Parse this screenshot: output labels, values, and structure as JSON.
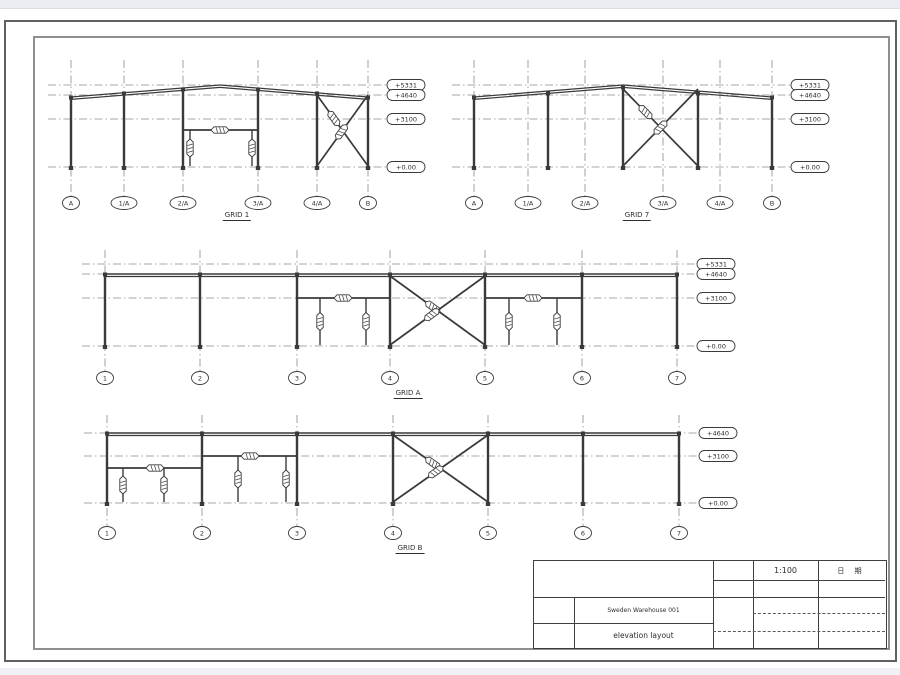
{
  "colors": {
    "member_line": "#3a3a3a",
    "grid_line": "#8a8a8a",
    "border_outer": "#606060",
    "border_inner": "#8f8f8f",
    "chrome_strip": "#ecedf2",
    "paper": "#ffffff"
  },
  "title_block": {
    "scale": "1:100",
    "date_label": "日 期",
    "project": "Sweden Warehouse 001",
    "sheet_title": "elevation layout"
  },
  "views": [
    {
      "name": "GRID 1",
      "caption": {
        "x": 237,
        "y": 211
      },
      "grids": [
        {
          "label": "A",
          "x": 71
        },
        {
          "label": "1/A",
          "x": 124
        },
        {
          "label": "2/A",
          "x": 183
        },
        {
          "label": "3/A",
          "x": 258
        },
        {
          "label": "4/A",
          "x": 317
        },
        {
          "label": "B",
          "x": 368
        }
      ],
      "bubble_y": 203,
      "grid_top": 60,
      "grid_bottom": 195,
      "levels": [
        {
          "label": "+5331",
          "y": 85
        },
        {
          "label": "+4640",
          "y": 95
        },
        {
          "label": "+3100",
          "y": 119
        },
        {
          "label": "+0.00",
          "y": 167
        }
      ],
      "level_x1": 48,
      "tag_x": 406,
      "rafters": [
        [
          71,
          97,
          220,
          85
        ],
        [
          220,
          85,
          368,
          97
        ]
      ],
      "beams": [],
      "columns": [
        [
          71,
          97,
          167
        ],
        [
          124,
          93,
          167
        ],
        [
          183,
          89,
          167
        ],
        [
          258,
          89,
          167
        ],
        [
          317,
          93,
          167
        ],
        [
          368,
          97,
          167
        ]
      ],
      "braces": [
        {
          "x1": 317,
          "y1": 95,
          "x2": 368,
          "y2": 166,
          "t": 0.33
        },
        {
          "x1": 368,
          "y1": 95,
          "x2": 317,
          "y2": 166,
          "t": 0.52
        }
      ],
      "struts": [
        {
          "x1": 183,
          "x2": 258,
          "y": 130,
          "tb": 220
        }
      ],
      "hangers": [
        [
          190,
          130,
          166
        ],
        [
          252,
          130,
          166
        ]
      ]
    },
    {
      "name": "GRID 7",
      "caption": {
        "x": 637,
        "y": 211
      },
      "grids": [
        {
          "label": "A",
          "x": 474
        },
        {
          "label": "1/A",
          "x": 528
        },
        {
          "label": "2/A",
          "x": 585
        },
        {
          "label": "3/A",
          "x": 663
        },
        {
          "label": "4/A",
          "x": 720
        },
        {
          "label": "B",
          "x": 772
        }
      ],
      "bubble_y": 203,
      "grid_top": 60,
      "grid_bottom": 195,
      "levels": [
        {
          "label": "+5331",
          "y": 85
        },
        {
          "label": "+4640",
          "y": 95
        },
        {
          "label": "+3100",
          "y": 119
        },
        {
          "label": "+0.00",
          "y": 167
        }
      ],
      "level_x1": 452,
      "tag_x": 810,
      "rafters": [
        [
          474,
          97,
          623,
          85
        ],
        [
          623,
          85,
          772,
          97
        ]
      ],
      "beams": [],
      "columns": [
        [
          474,
          97,
          167
        ],
        [
          548,
          93,
          167
        ],
        [
          623,
          87,
          167
        ],
        [
          698,
          93,
          167
        ],
        [
          772,
          97,
          167
        ]
      ],
      "braces": [
        {
          "x1": 623,
          "y1": 89,
          "x2": 698,
          "y2": 166,
          "t": 0.3
        },
        {
          "x1": 698,
          "y1": 89,
          "x2": 623,
          "y2": 166,
          "t": 0.5
        }
      ],
      "struts": [],
      "hangers": []
    },
    {
      "name": "GRID A",
      "caption": {
        "x": 408,
        "y": 389
      },
      "grids": [
        {
          "label": "1",
          "x": 105
        },
        {
          "label": "2",
          "x": 200
        },
        {
          "label": "3",
          "x": 297
        },
        {
          "label": "4",
          "x": 390
        },
        {
          "label": "5",
          "x": 485
        },
        {
          "label": "6",
          "x": 582
        },
        {
          "label": "7",
          "x": 677
        }
      ],
      "bubble_y": 378,
      "grid_top": 250,
      "grid_bottom": 370,
      "levels": [
        {
          "label": "+5331",
          "y": 264
        },
        {
          "label": "+4640",
          "y": 274
        },
        {
          "label": "+3100",
          "y": 298
        },
        {
          "label": "+0.00",
          "y": 346
        }
      ],
      "level_x1": 82,
      "tag_x": 716,
      "rafters": [],
      "beams": [
        [
          105,
          274,
          677
        ]
      ],
      "columns": [
        [
          105,
          274,
          346
        ],
        [
          200,
          274,
          346
        ],
        [
          297,
          274,
          346
        ],
        [
          390,
          274,
          346
        ],
        [
          485,
          274,
          346
        ],
        [
          582,
          274,
          346
        ],
        [
          677,
          274,
          346
        ]
      ],
      "braces": [
        {
          "x1": 390,
          "y1": 276,
          "x2": 485,
          "y2": 345,
          "t": 0.45
        },
        {
          "x1": 485,
          "y1": 276,
          "x2": 390,
          "y2": 345,
          "t": 0.56
        }
      ],
      "struts": [
        {
          "x1": 297,
          "x2": 390,
          "y": 298,
          "tb": 343
        },
        {
          "x1": 485,
          "x2": 582,
          "y": 298,
          "tb": 533
        }
      ],
      "hangers": [
        [
          320,
          298,
          345
        ],
        [
          366,
          298,
          345
        ],
        [
          509,
          298,
          345
        ],
        [
          557,
          298,
          345
        ]
      ]
    },
    {
      "name": "GRID B",
      "caption": {
        "x": 410,
        "y": 544
      },
      "grids": [
        {
          "label": "1",
          "x": 107
        },
        {
          "label": "2",
          "x": 202
        },
        {
          "label": "3",
          "x": 297
        },
        {
          "label": "4",
          "x": 393
        },
        {
          "label": "5",
          "x": 488
        },
        {
          "label": "6",
          "x": 583
        },
        {
          "label": "7",
          "x": 679
        }
      ],
      "bubble_y": 533,
      "grid_top": 415,
      "grid_bottom": 525,
      "levels": [
        {
          "label": "+4640",
          "y": 433
        },
        {
          "label": "+3100",
          "y": 456
        },
        {
          "label": "+0.00",
          "y": 503
        }
      ],
      "level_x1": 84,
      "tag_x": 718,
      "rafters": [],
      "beams": [
        [
          107,
          433,
          679
        ]
      ],
      "columns": [
        [
          107,
          433,
          503
        ],
        [
          202,
          433,
          503
        ],
        [
          297,
          433,
          503
        ],
        [
          393,
          433,
          503
        ],
        [
          488,
          433,
          503
        ],
        [
          583,
          433,
          503
        ],
        [
          679,
          433,
          503
        ]
      ],
      "braces": [
        {
          "x1": 393,
          "y1": 435,
          "x2": 488,
          "y2": 502,
          "t": 0.42
        },
        {
          "x1": 488,
          "y1": 435,
          "x2": 393,
          "y2": 502,
          "t": 0.55
        }
      ],
      "struts": [
        {
          "x1": 107,
          "x2": 202,
          "y": 468,
          "tb": 155
        },
        {
          "x1": 202,
          "x2": 297,
          "y": 456,
          "tb": 250
        }
      ],
      "hangers": [
        [
          123,
          468,
          502
        ],
        [
          164,
          468,
          502
        ],
        [
          238,
          456,
          502
        ],
        [
          286,
          456,
          502
        ]
      ]
    }
  ]
}
